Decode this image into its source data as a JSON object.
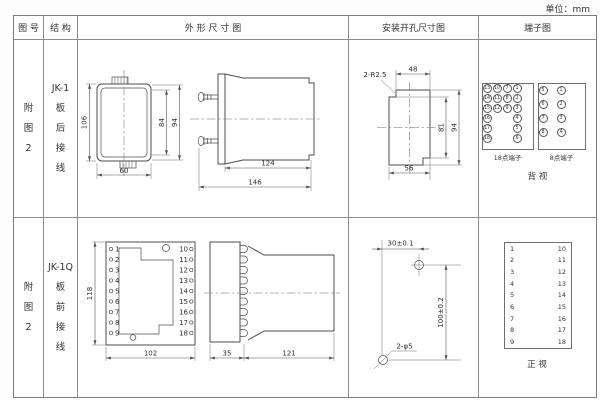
{
  "unit_label": "单位：mm",
  "colors": {
    "line": "#4d4d4d",
    "text": "#2e2e2e",
    "table_border": "#8c8c8c",
    "background": "#ffffff"
  },
  "header": {
    "fig": "图 号",
    "structure": "结 构",
    "outline": "外 形 尺 寸 图",
    "mounting": "安装开孔尺寸图",
    "terminal": "端子图"
  },
  "row1": {
    "fig": [
      "附",
      "图",
      "2"
    ],
    "model": "JK-1",
    "wiring": [
      "板",
      "后",
      "接",
      "线"
    ],
    "outline": {
      "dim_height": "106",
      "dim_width": "60",
      "dim_inner": "84",
      "dim_outer": "94",
      "dim_body": "124",
      "dim_total": "146"
    },
    "mounting": {
      "radius_label": "2-R2.5",
      "dim_top": "48",
      "dim_inner_h": "81",
      "dim_outer_h": "94",
      "dim_bottom": "56"
    },
    "terminal": {
      "grid18": [
        [
          "13",
          "10",
          "7",
          "1"
        ],
        [
          "14",
          "11",
          "8",
          "2"
        ],
        [
          "15",
          "12",
          "9",
          "3"
        ],
        [
          "16",
          "",
          "",
          "4"
        ],
        [
          "17",
          "",
          "",
          "5"
        ],
        [
          "18",
          "",
          "",
          "6"
        ]
      ],
      "grid8": [
        [
          "5",
          "1"
        ],
        [
          "6",
          "2"
        ],
        [
          "7",
          "3"
        ],
        [
          "8",
          "4"
        ]
      ],
      "label18": "18点端子",
      "label8": "8点端子",
      "view": "背 视"
    }
  },
  "row2": {
    "fig": [
      "附",
      "图",
      "2"
    ],
    "model": "JK-1Q",
    "wiring": [
      "板",
      "前",
      "接",
      "线"
    ],
    "outline": {
      "dim_height": "118",
      "dim_width": "102",
      "dim_plate": "35",
      "dim_body": "121",
      "left_terminals": [
        "1",
        "2",
        "3",
        "4",
        "5",
        "6",
        "7",
        "8",
        "9"
      ],
      "right_terminals": [
        "10",
        "11",
        "12",
        "13",
        "14",
        "15",
        "16",
        "17",
        "18"
      ]
    },
    "mounting": {
      "dim_h": "30±0.1",
      "dim_v": "100±0.2",
      "hole_label": "2-φ5"
    },
    "terminal": {
      "left": [
        "1",
        "2",
        "3",
        "4",
        "5",
        "6",
        "7",
        "8",
        "9"
      ],
      "right": [
        "10",
        "11",
        "12",
        "13",
        "14",
        "15",
        "16",
        "17",
        "18"
      ],
      "view": "正 视"
    }
  }
}
